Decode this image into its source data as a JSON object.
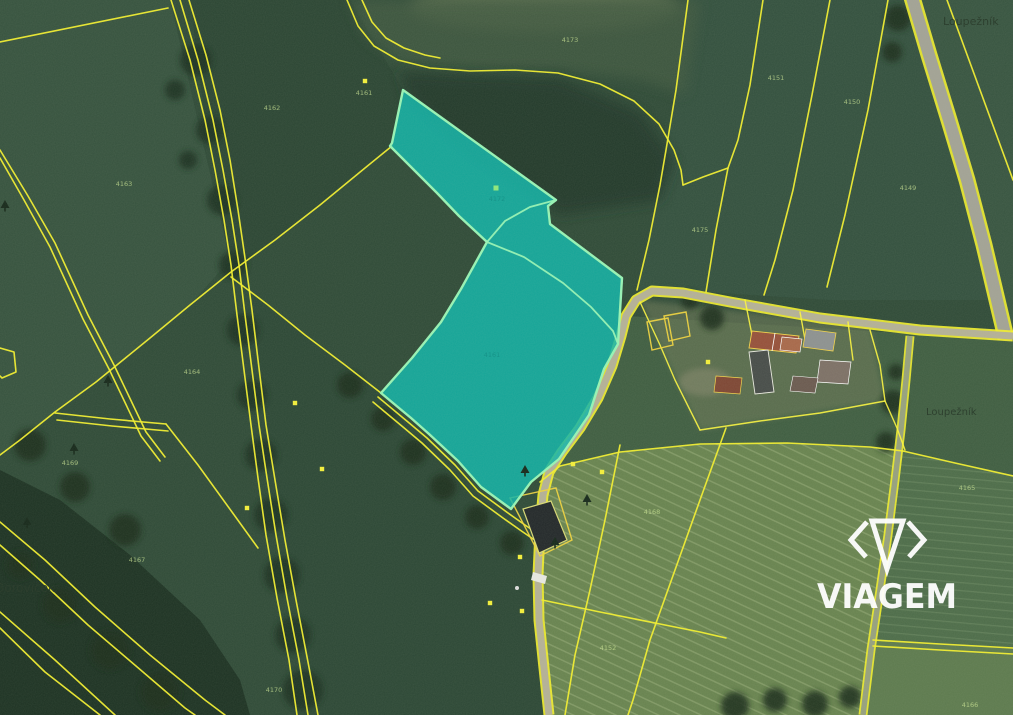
{
  "map": {
    "type": "cadastral-aerial-view",
    "colors": {
      "parcel_line_yellow": "#f2ee2e",
      "highlight_fill": "#12b5a9",
      "highlight_border": "#97f3b4",
      "field_dark_green": "#2f4a37",
      "field_light_green": "#68834f",
      "forest_green": "#1d3223",
      "road_grey": "#a2a295",
      "road_tan": "#b4b096",
      "watermark_white": "#ffffff"
    },
    "highlight": {
      "fill": "#12b5a9",
      "fill_opacity": 0.86,
      "stroke": "#97f3b4",
      "stroke_width": 2.4,
      "outer_points": "403,90 556,200 548,206 550,224 622,278 618,344 604,369 589,415 559,459 531,482 511,509 481,487 458,461 429,434 411,418 381,393 412,358 441,322 461,289 487,242 459,216 437,193 414,170 394,150 390,146 392,143",
      "inner_lines": [
        "487,242 524,257 563,283 591,307 613,331 618,344",
        "556,200 530,207 505,221 487,242"
      ],
      "labels": [
        {
          "text": "4172",
          "x": 497,
          "y": 201
        },
        {
          "text": "4161",
          "x": 492,
          "y": 357
        }
      ],
      "label_color": "#0d8f86"
    },
    "markers": {
      "yellow_square_color": "#f4ef3a",
      "green_square_color": "#8ee87a",
      "tree_symbol_color": "#16281a",
      "yellow_squares": [
        [
          365,
          81
        ],
        [
          295,
          403
        ],
        [
          322,
          469
        ],
        [
          247,
          508
        ],
        [
          573,
          464
        ],
        [
          602,
          472
        ],
        [
          520,
          557
        ],
        [
          490,
          603
        ],
        [
          522,
          611
        ],
        [
          708,
          362
        ]
      ],
      "green_squares": [
        [
          496,
          188
        ]
      ],
      "tree_symbols": [
        [
          5,
          208
        ],
        [
          108,
          383
        ],
        [
          74,
          451
        ],
        [
          27,
          525
        ],
        [
          555,
          545
        ],
        [
          587,
          502
        ],
        [
          525,
          473
        ]
      ]
    },
    "parcel_numbers": {
      "color": "#cfe896",
      "items": [
        {
          "text": "4163",
          "x": 124,
          "y": 186
        },
        {
          "text": "4162",
          "x": 272,
          "y": 110
        },
        {
          "text": "4161",
          "x": 364,
          "y": 95
        },
        {
          "text": "4173",
          "x": 570,
          "y": 42
        },
        {
          "text": "4151",
          "x": 776,
          "y": 80
        },
        {
          "text": "4150",
          "x": 852,
          "y": 104
        },
        {
          "text": "4149",
          "x": 908,
          "y": 190
        },
        {
          "text": "4175",
          "x": 700,
          "y": 232
        },
        {
          "text": "4168",
          "x": 652,
          "y": 514
        },
        {
          "text": "4165",
          "x": 967,
          "y": 490
        },
        {
          "text": "4166",
          "x": 970,
          "y": 707
        },
        {
          "text": "4164",
          "x": 192,
          "y": 374
        },
        {
          "text": "4167",
          "x": 137,
          "y": 562
        },
        {
          "text": "4170",
          "x": 274,
          "y": 692
        },
        {
          "text": "4169",
          "x": 70,
          "y": 465
        },
        {
          "text": "4152",
          "x": 608,
          "y": 650
        }
      ]
    },
    "place_labels": {
      "color": "#243626",
      "items": [
        {
          "text": "Loupežník",
          "x": 943,
          "y": 25,
          "size": 11
        },
        {
          "text": "Loupežník",
          "x": 926,
          "y": 415,
          "size": 10
        },
        {
          "text": "Borovíček",
          "x": -4,
          "y": 592,
          "size": 12
        }
      ]
    },
    "watermark": {
      "text": "VIAGEM",
      "x": 887,
      "y": 608,
      "text_length": 140,
      "font_size": 34,
      "color": "#ffffff",
      "opacity": 0.95
    }
  }
}
